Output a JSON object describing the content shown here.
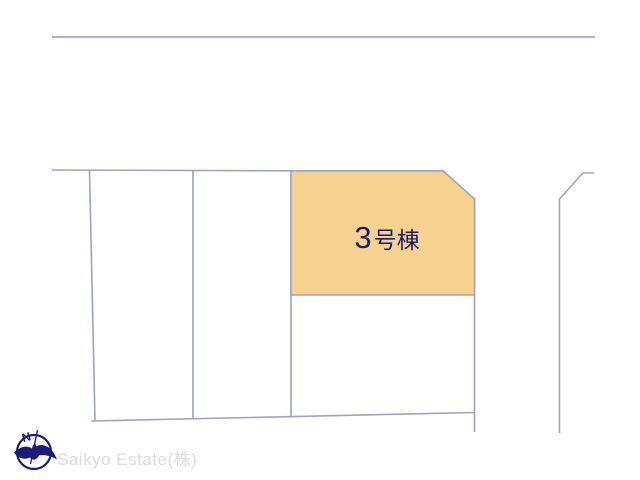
{
  "page": {
    "background_color": "#ffffff"
  },
  "header": {
    "rule_color": "#b2b5c9"
  },
  "site_plan": {
    "boundary_color": "#9fa2c2",
    "lots": {
      "highlighted": {
        "number": "3",
        "suffix": "号棟",
        "fill_color": "#f6d28e",
        "label_color": "#1c1c70"
      }
    }
  },
  "branding": {
    "company_name": "Saikyo Estate(株)",
    "company_color": "#dcdcdd",
    "compass": {
      "north_label": "N",
      "color": "#1b1b7a"
    }
  }
}
